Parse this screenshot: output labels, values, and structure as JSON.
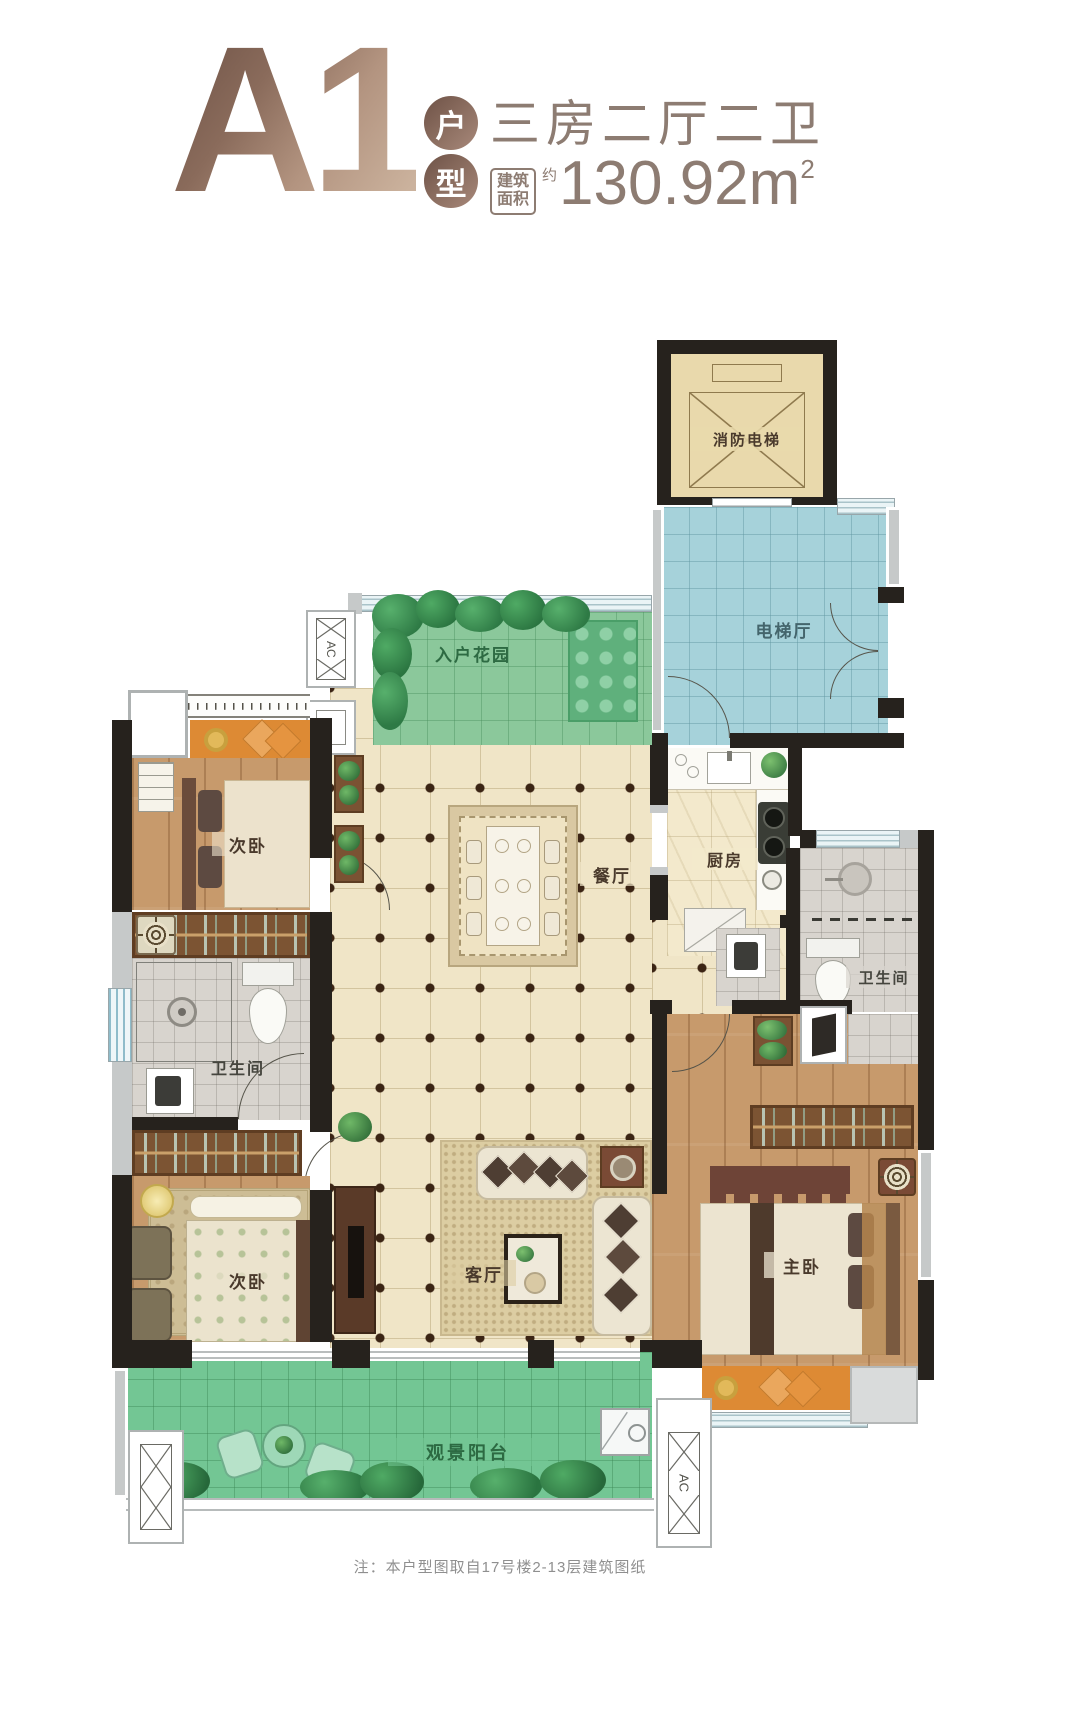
{
  "header": {
    "unit_code": "A1",
    "unit_type_top": "户",
    "unit_type_bottom": "型",
    "layout_summary": "三房二厅二卫",
    "area_label_top": "建筑",
    "area_label_bottom": "面积",
    "area_prefix": "约",
    "area_value": "130.92m",
    "area_superscript": "2"
  },
  "rooms": {
    "fire_elevator": "消防电梯",
    "elevator_hall": "电梯厅",
    "entry_garden": "入户花园",
    "bedroom_top": "次卧",
    "dining_room": "餐厅",
    "kitchen": "厨房",
    "bathroom_left": "卫生间",
    "bathroom_right": "卫生间",
    "living_room": "客厅",
    "master_bedroom": "主卧",
    "bedroom_bottom": "次卧",
    "balcony": "观景阳台"
  },
  "annotations": {
    "ac_label": "AC",
    "note": "注：本户型图取自17号楼2-13层建筑图纸"
  },
  "colors": {
    "title_bronze_dark": "#6e5246",
    "title_bronze_light": "#cbb29d",
    "header_text": "#8d7c72",
    "wall": "#26221d",
    "hall_blue": "#a6d2da",
    "garden_green": "#8bc89b",
    "balcony_green": "#73c694",
    "floor_cream": "#f0e5c7",
    "wood": "#c79a6c",
    "tile_gray": "#d8d4ce",
    "bay_orange": "#dd8a34",
    "elevator_tan": "#e9d9ac"
  }
}
